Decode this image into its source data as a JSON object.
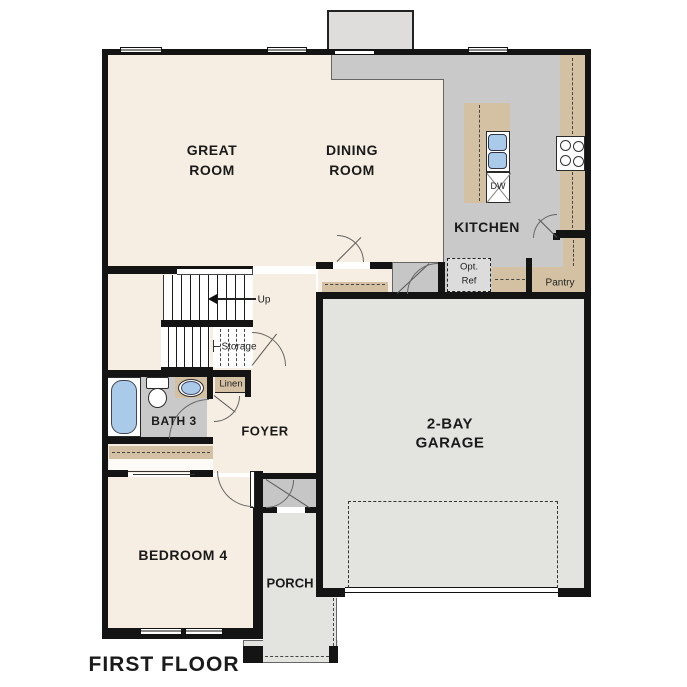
{
  "title": "FIRST FLOOR",
  "colors": {
    "wall": "#141414",
    "living_floor": "#f6eee2",
    "kitchen_floor": "#c9c9c9",
    "garage_floor": "#e3e3e0",
    "cabinet_tan": "#d4c1a3",
    "fixture_blue": "#a9cbe9"
  },
  "rooms": {
    "great_room": {
      "line1": "GREAT",
      "line2": "ROOM"
    },
    "dining_room": {
      "line1": "DINING",
      "line2": "ROOM"
    },
    "kitchen": {
      "label": "KITCHEN"
    },
    "garage": {
      "line1": "2-BAY",
      "line2": "GARAGE"
    },
    "bedroom4": {
      "label": "BEDROOM 4"
    },
    "bath3": {
      "label": "BATH 3"
    },
    "foyer": {
      "label": "FOYER"
    },
    "porch": {
      "label": "PORCH"
    },
    "pantry": {
      "label": "Pantry"
    }
  },
  "closets": {
    "storage": "Storage",
    "linen": "Linen"
  },
  "stairs": {
    "up": "Up"
  },
  "appliances": {
    "opt_ref_line1": "Opt.",
    "opt_ref_line2": "Ref",
    "dishwasher": "DW"
  }
}
